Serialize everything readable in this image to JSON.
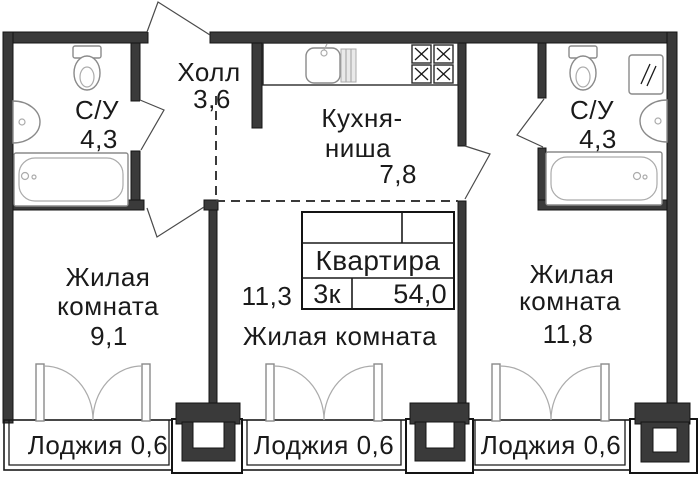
{
  "plan": {
    "title_block": {
      "title": "Квартира",
      "rooms_code": "3к",
      "total_area": "54,0"
    },
    "labels": {
      "hall": {
        "name": "Холл",
        "area": "3,6"
      },
      "bath_left": {
        "name": "С/У",
        "area": "4,3"
      },
      "bath_right": {
        "name": "С/У",
        "area": "4,3"
      },
      "kitchen": {
        "line1": "Кухня-",
        "line2": "ниша",
        "area": "7,8"
      },
      "room_left": {
        "line1": "Жилая",
        "line2": "комната",
        "area": "9,1"
      },
      "room_mid": {
        "name": "Жилая комната",
        "area": "11,3"
      },
      "room_right": {
        "line1": "Жилая",
        "line2": "комната",
        "area": "11,8"
      },
      "loggia_left": {
        "name": "Лоджия 0,6"
      },
      "loggia_mid": {
        "name": "Лоджия 0,6"
      },
      "loggia_right": {
        "name": "Лоджия 0,6"
      }
    },
    "colors": {
      "background": "#ffffff",
      "wall": "#3a3a3a",
      "wall_outline": "#141414",
      "line": "#1a1a1a",
      "fixture": "#8a8a8a",
      "text": "#1a1a1a"
    }
  }
}
